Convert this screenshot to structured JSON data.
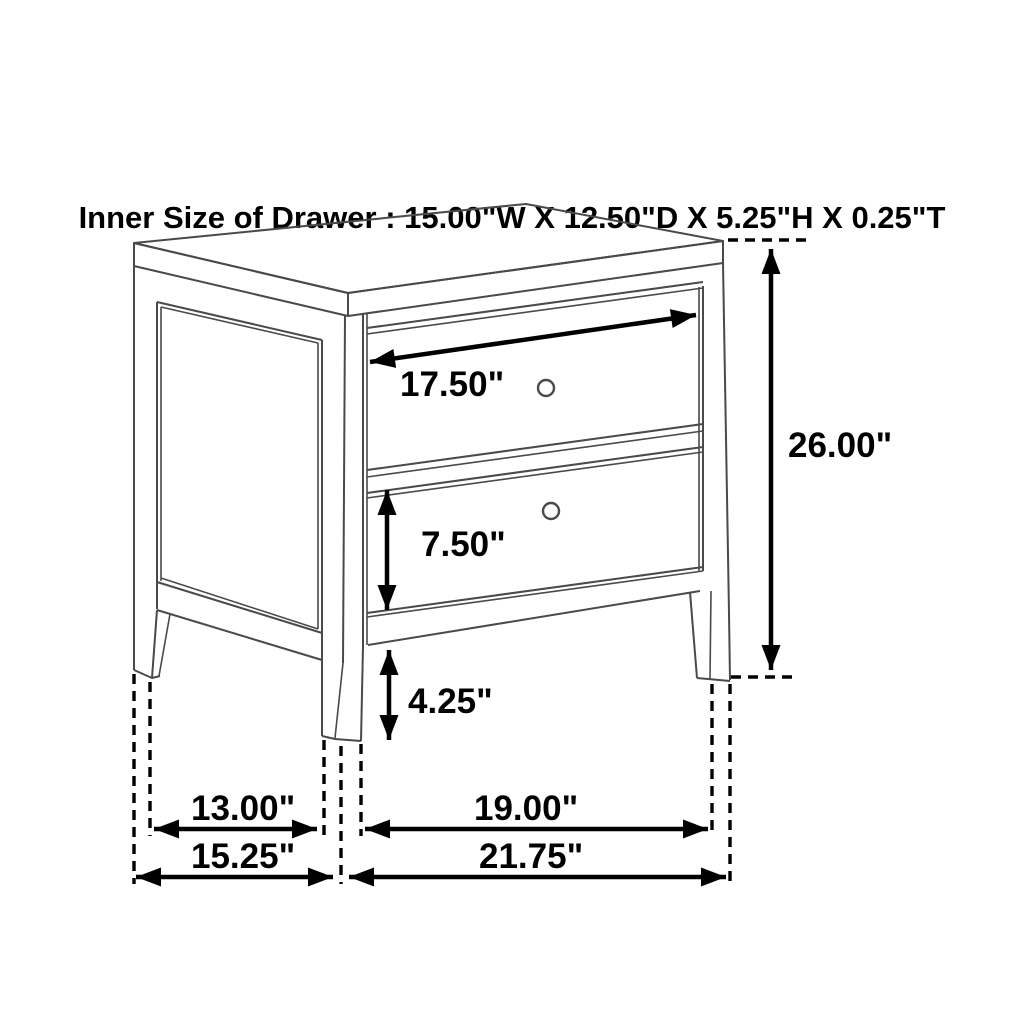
{
  "title": "Inner Size of Drawer : 15.00\"W X 12.50\"D X 5.25\"H X 0.25\"T",
  "dimensions": {
    "drawer_inner_width": {
      "label": "17.50\""
    },
    "drawer_front_height": {
      "label": "7.50\""
    },
    "leg_clearance_height": {
      "label": "4.25\""
    },
    "overall_height": {
      "label": "26.00\""
    },
    "side_leg_span": {
      "label": "13.00\""
    },
    "front_leg_span": {
      "label": "19.00\""
    },
    "overall_depth": {
      "label": "15.25\""
    },
    "overall_width": {
      "label": "21.75\""
    }
  },
  "colors": {
    "background": "#ffffff",
    "furniture_line": "#4a4a4a",
    "dimension_line": "#000000"
  }
}
